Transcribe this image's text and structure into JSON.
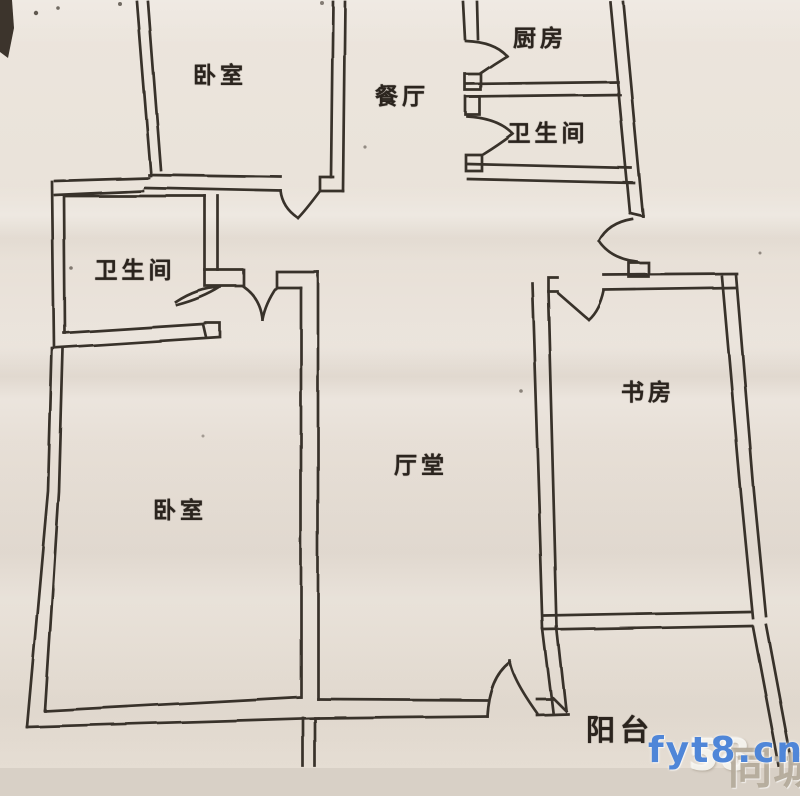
{
  "plan": {
    "title": "apartment-floor-plan",
    "rooms": {
      "bedroom_top": "卧室",
      "dining": "餐厅",
      "kitchen": "厨房",
      "bath_top": "卫生间",
      "bath_left": "卫生间",
      "study": "书房",
      "hall": "厅堂",
      "bedroom_bottom": "卧室",
      "balcony": "阳台"
    },
    "colors": {
      "paper": "#e8e0d7",
      "wall_line": "#38302a",
      "watermark_blue": "#4f86d8",
      "watermark_gray": "#b0a696"
    },
    "watermark": {
      "site": "fyt8.cn",
      "brand_58": "58",
      "brand_tc": "同城"
    }
  }
}
